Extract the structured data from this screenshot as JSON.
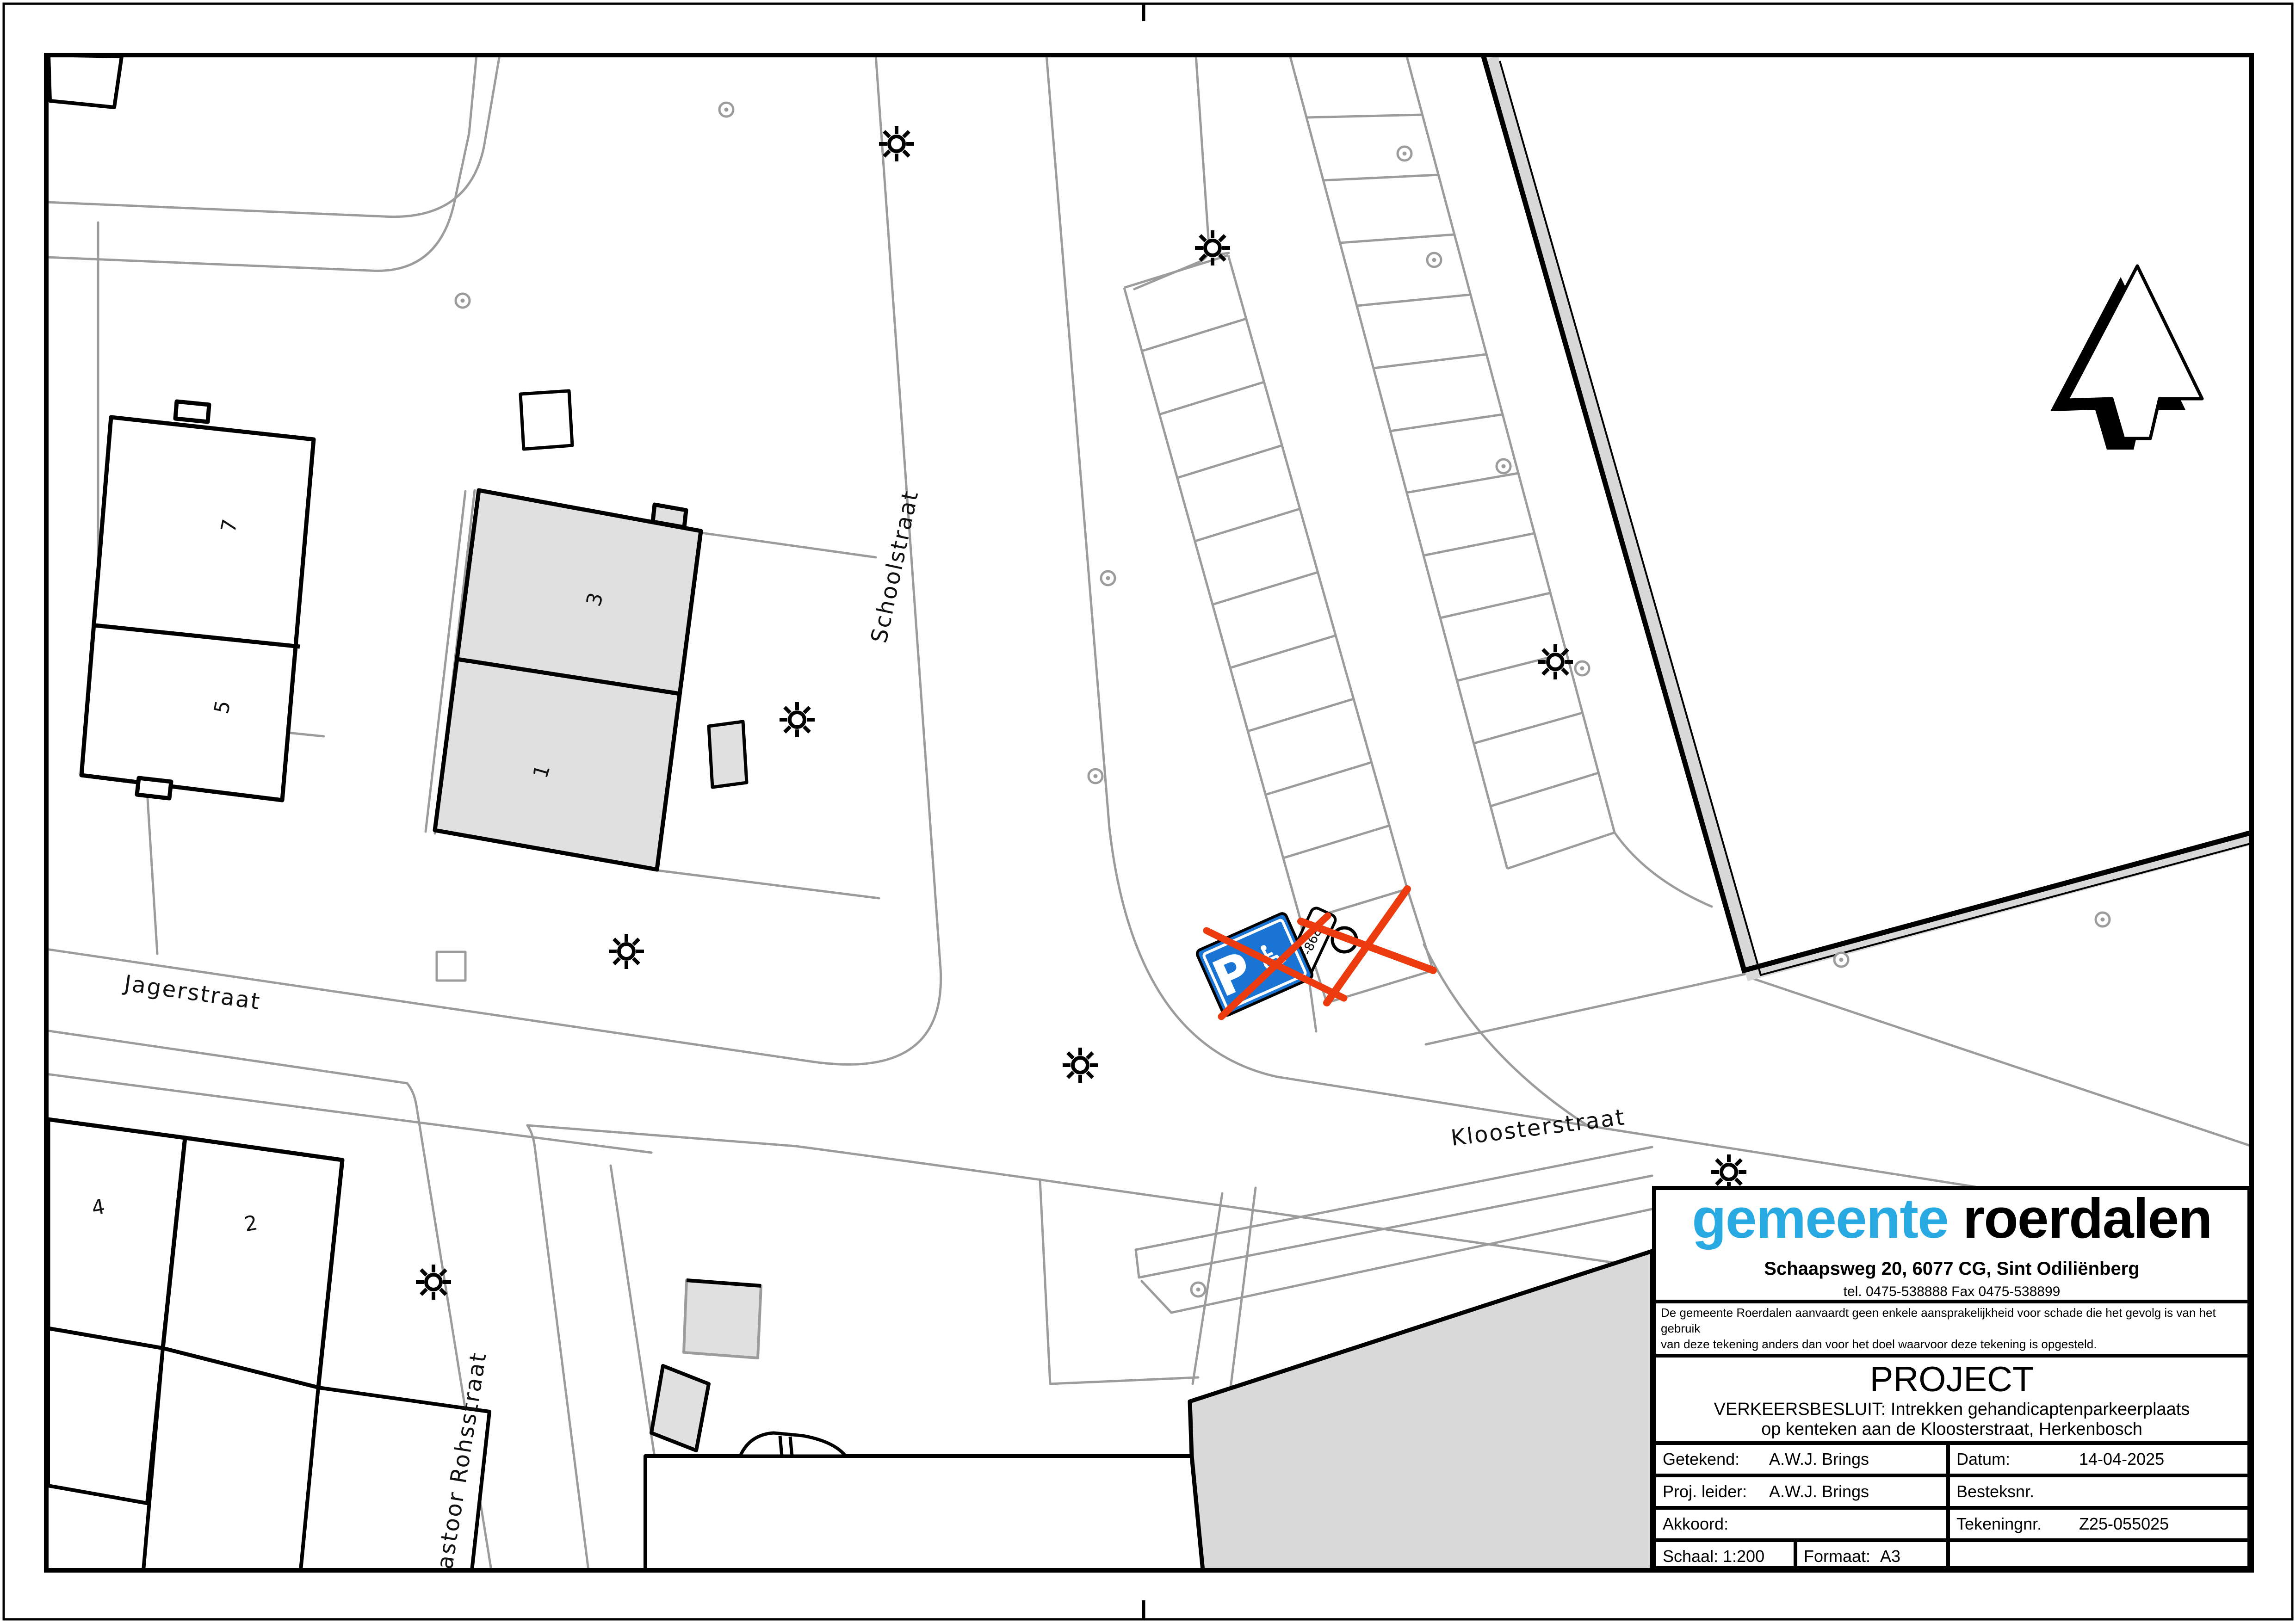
{
  "map": {
    "streets": {
      "schoolstraat": "Schoolstraat",
      "jagerstraat": "Jagerstraat",
      "kloosterstraat": "Kloosterstraat",
      "pastoor_rohsstraat": "astoor  Rohsstraat"
    },
    "house_numbers": {
      "b7": "7",
      "b5": "5",
      "b3": "3",
      "b1": "1",
      "b4": "4",
      "b2": "2"
    },
    "parking_sign": {
      "p_letter": "P",
      "wheelchair": "♿",
      "kenteken": "P-868"
    },
    "symbols": {
      "street_light": "sun-burst-icon",
      "tree": "circle-dot-icon",
      "north_arrow": "north-arrow-icon"
    }
  },
  "title_block": {
    "logo": {
      "blue": "gemeente",
      "black": " roerdalen"
    },
    "address": "Schaapsweg 20, 6077 CG, Sint Odiliënberg",
    "phone_fax": "tel. 0475-538888  Fax 0475-538899",
    "disclaimer_line1": "De gemeente Roerdalen aanvaardt geen enkele aansprakelijkheid voor schade die het gevolg is van het gebruik",
    "disclaimer_line2": "van deze tekening anders dan voor het doel waarvoor deze tekening is opgesteld.",
    "project_heading": "PROJECT",
    "project_line1": "VERKEERSBESLUIT: Intrekken gehandicaptenparkeerplaats",
    "project_line2": "op kenteken aan de Kloosterstraat, Herkenbosch",
    "fields": {
      "getekend_label": "Getekend:",
      "getekend_value": "A.W.J. Brings",
      "datum_label": "Datum:",
      "datum_value": "14-04-2025",
      "proj_leider_label": "Proj. leider:",
      "proj_leider_value": "A.W.J. Brings",
      "besteksnr_label": "Besteksnr.",
      "akkoord_label": "Akkoord:",
      "tekeningnr_label": "Tekeningnr.",
      "tekeningnr_value": "Z25-055025",
      "schaal_label": "Schaal:",
      "schaal_value": "1:200",
      "formaat_label": "Formaat:",
      "formaat_value": "A3"
    }
  },
  "colors": {
    "logo_blue": "#29a9e1",
    "sign_blue": "#1a74d4",
    "cross_orange": "#ec3b0f",
    "map_line_gray": "#9c9c9c",
    "building_fill_gray": "#e0e0e0",
    "parcel_band_gray": "#d8d8d8"
  }
}
